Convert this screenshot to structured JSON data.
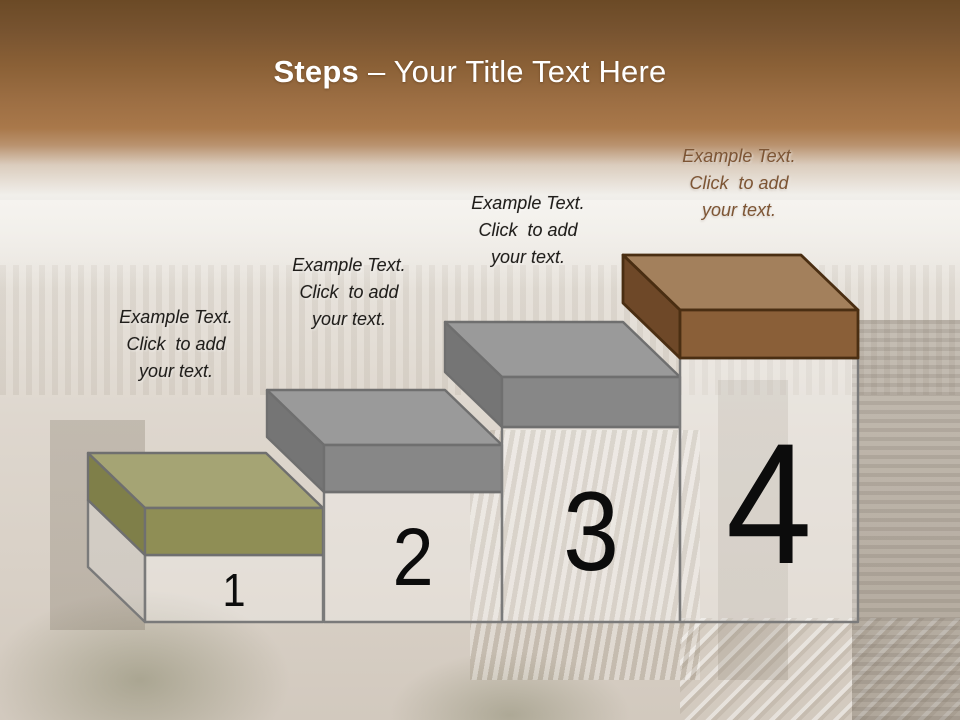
{
  "slide": {
    "title": {
      "bold": "Steps",
      "rest": "– Your Title Text Here"
    },
    "header": {
      "band_top_color": "#6b4a26",
      "band_mid_color": "#a9784a",
      "title_color": "#ffffff"
    },
    "steps": [
      {
        "number": "1",
        "label": "Example Text.\nClick  to add\nyour text.",
        "label_color": "#201e1b",
        "cap_top": "#a5a474",
        "cap_front": "#8f8e55",
        "cap_side": "#7f7f49",
        "outline": "#6f6f6f"
      },
      {
        "number": "2",
        "label": "Example Text.\nClick  to add\nyour text.",
        "label_color": "#201e1b",
        "cap_top": "#9a9a9a",
        "cap_front": "#878787",
        "cap_side": "#757575",
        "outline": "#6f6f6f"
      },
      {
        "number": "3",
        "label": "Example Text.\nClick  to add\nyour text.",
        "label_color": "#201e1b",
        "cap_top": "#9a9a9a",
        "cap_front": "#878787",
        "cap_side": "#757575",
        "outline": "#6f6f6f"
      },
      {
        "number": "4",
        "label": "Example Text.\nClick  to add\nyour text.",
        "label_color": "#7d5534",
        "cap_top": "#a3805c",
        "cap_front": "#8a5f38",
        "cap_side": "#6e4828",
        "outline": "#4a2e12"
      }
    ],
    "body_fill": "rgba(255,255,255,0.30)",
    "body_outline": "#7a7a7a",
    "number_color": "#0c0c0c"
  }
}
